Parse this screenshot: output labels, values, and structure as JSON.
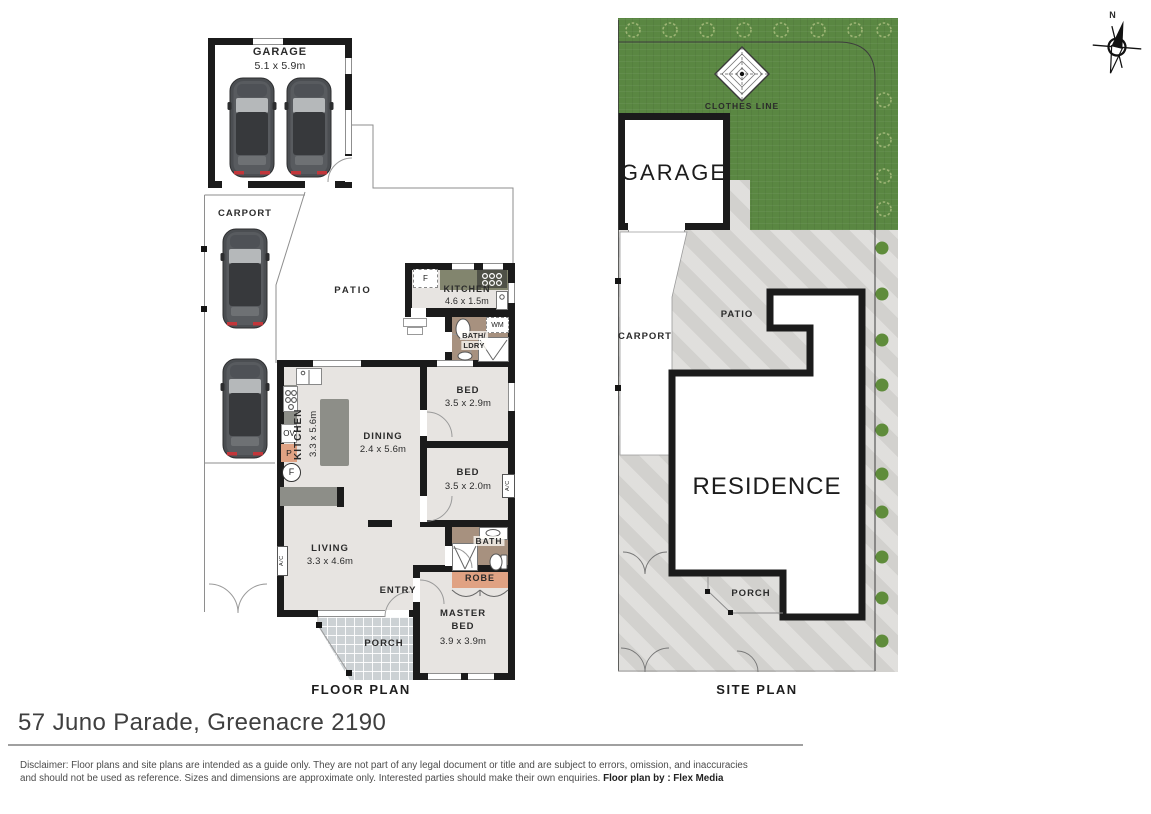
{
  "floor_plan": {
    "label": "FLOOR PLAN",
    "garage": {
      "name": "GARAGE",
      "dims": "5.1 x 5.9m"
    },
    "carport": {
      "name": "CARPORT"
    },
    "patio": {
      "name": "PATIO"
    },
    "kitchenette": {
      "name": "KITCHEN",
      "dims": "4.6 x 1.5m",
      "fridge": "F",
      "washing_machine": "WM"
    },
    "bath_laundry": {
      "line1": "BATH/",
      "line2": "LDRY"
    },
    "bed1": {
      "name": "BED",
      "dims": "3.5 x 2.9m"
    },
    "bed2": {
      "name": "BED",
      "dims": "3.5 x 2.0m",
      "ac": "A/C"
    },
    "kitchen": {
      "name": "KITCHEN",
      "dims": "3.3 x 5.6m",
      "oven": "OV",
      "pantry": "P",
      "fridge": "F"
    },
    "dining": {
      "name": "DINING",
      "dims": "2.4 x 5.6m"
    },
    "living": {
      "name": "LIVING",
      "dims": "3.3 x 4.6m",
      "ac": "A/C"
    },
    "bath": {
      "name": "BATH"
    },
    "robe": {
      "name": "ROBE"
    },
    "master_bed": {
      "line1": "MASTER",
      "line2": "BED",
      "dims": "3.9 x 3.9m"
    },
    "entry": {
      "name": "ENTRY"
    },
    "porch": {
      "name": "PORCH"
    }
  },
  "site_plan": {
    "label": "SITE PLAN",
    "clothes_line": "CLOTHES LINE",
    "garage": "GARAGE",
    "carport": "CARPORT",
    "patio": "PATIO",
    "residence": "RESIDENCE",
    "porch": "PORCH"
  },
  "compass": {
    "north": "N"
  },
  "footer": {
    "address": "57 Juno Parade, Greenacre 2190",
    "disclaimer_line1": "Disclaimer: Floor plans and site plans are intended as a guide only. They are not part of any legal document or title and are subject to errors, omission, and inaccuracies",
    "disclaimer_line2": "and should not be used as reference. Sizes and dimensions are approximate only. Interested parties should make their own enquiries.",
    "credit": "Floor plan by : Flex Media"
  },
  "colors": {
    "wall": "#1b1b1b",
    "floor": "#e7e4e1",
    "counter": "#8d8e88",
    "counter2": "#82856e",
    "bathfloor": "#a7917f",
    "robe": "#e0a283",
    "tile": "#ccd1d4",
    "grass": "#5a8742",
    "concrete": "#d7d6d3",
    "shrub": "#5f8c3b"
  }
}
